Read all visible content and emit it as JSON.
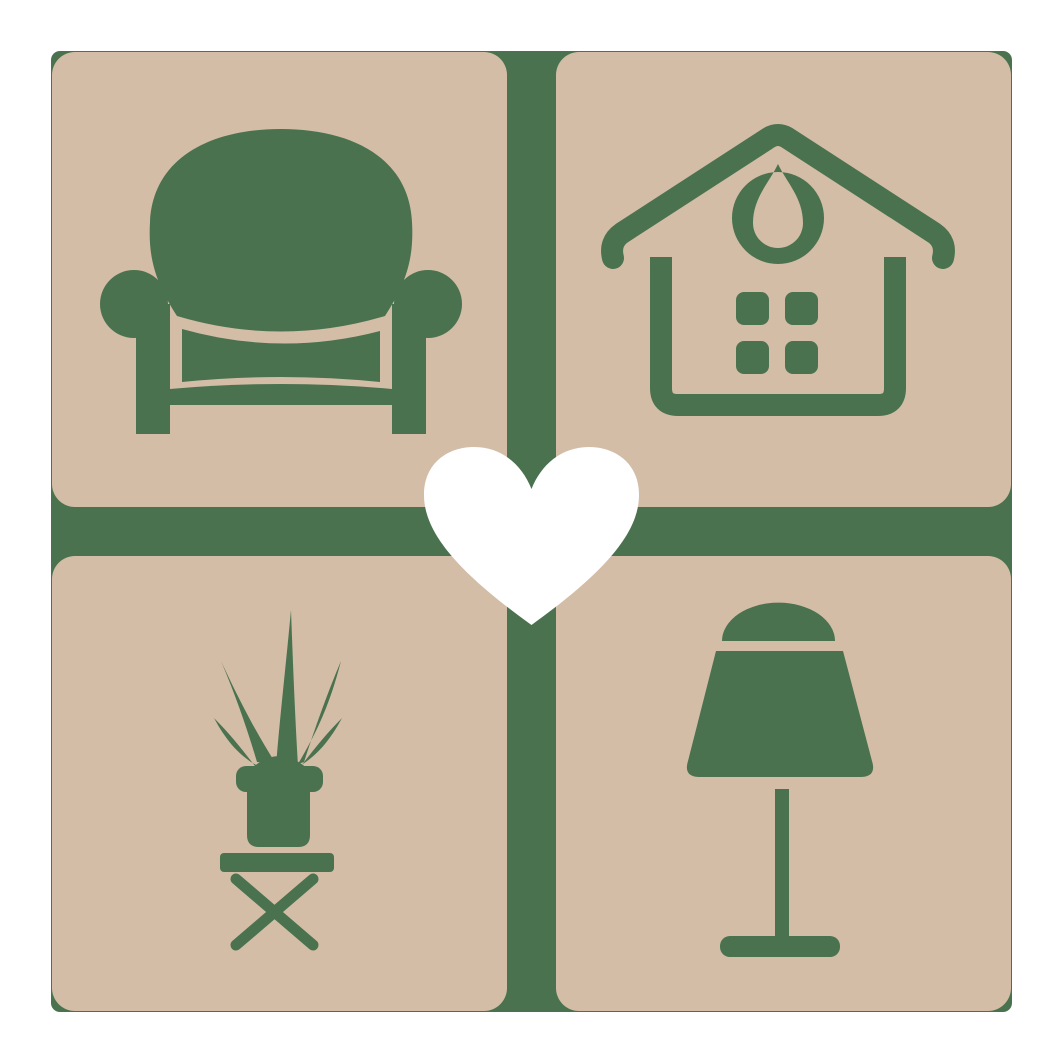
{
  "logo": {
    "description": "Home and furniture love logo: 2x2 grid of rounded beige tiles with green furniture icons (armchair, house, potted plant on stool, table lamp), separated by a green cross, with a white heart in the center",
    "colors": {
      "background": "#ffffff",
      "green": "#4a724e",
      "tile": "#d3bda7",
      "heart": "#ffffff"
    },
    "grid": {
      "rows": 2,
      "cols": 2,
      "tile_size": 455,
      "gap": 49,
      "margin": 52,
      "tile_corner_radius": 23
    },
    "tiles": [
      {
        "id": "armchair",
        "label": "armchair icon",
        "position": "top-left"
      },
      {
        "id": "house",
        "label": "house with round gable ornament and four-pane window icon",
        "position": "top-right"
      },
      {
        "id": "plant",
        "label": "potted plant on cross-legged stool icon",
        "position": "bottom-left"
      },
      {
        "id": "lamp",
        "label": "table lamp icon",
        "position": "bottom-right"
      }
    ],
    "center": {
      "id": "heart",
      "label": "white heart"
    }
  }
}
